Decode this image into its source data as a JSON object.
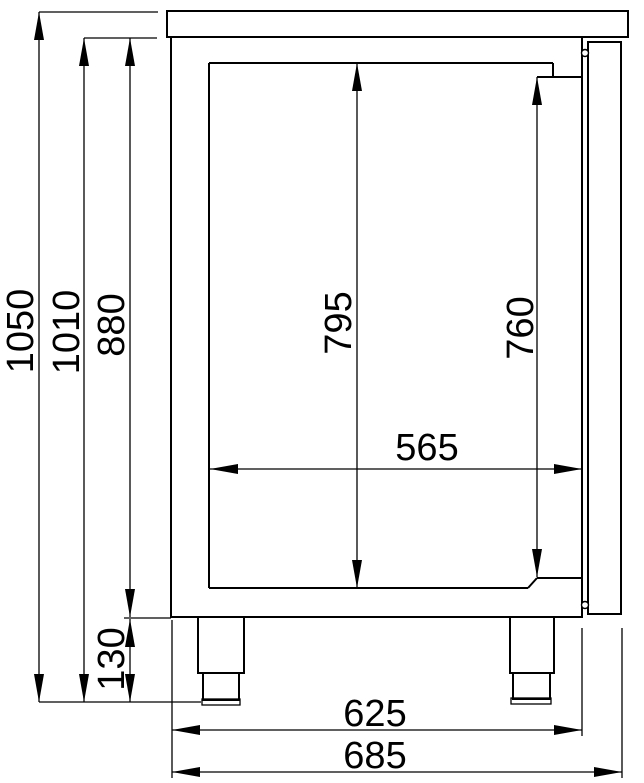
{
  "drawing": {
    "kind": "technical-dimension-side-view",
    "colors": {
      "line": "#000000",
      "background": "#ffffff"
    },
    "dimensions": {
      "overall_height": "1050",
      "height_excl_worktop": "1010",
      "body_height": "880",
      "leg_height": "130",
      "door_opening_height": "795",
      "inner_height": "760",
      "inner_depth": "565",
      "body_depth": "625",
      "overall_depth": "685"
    }
  }
}
